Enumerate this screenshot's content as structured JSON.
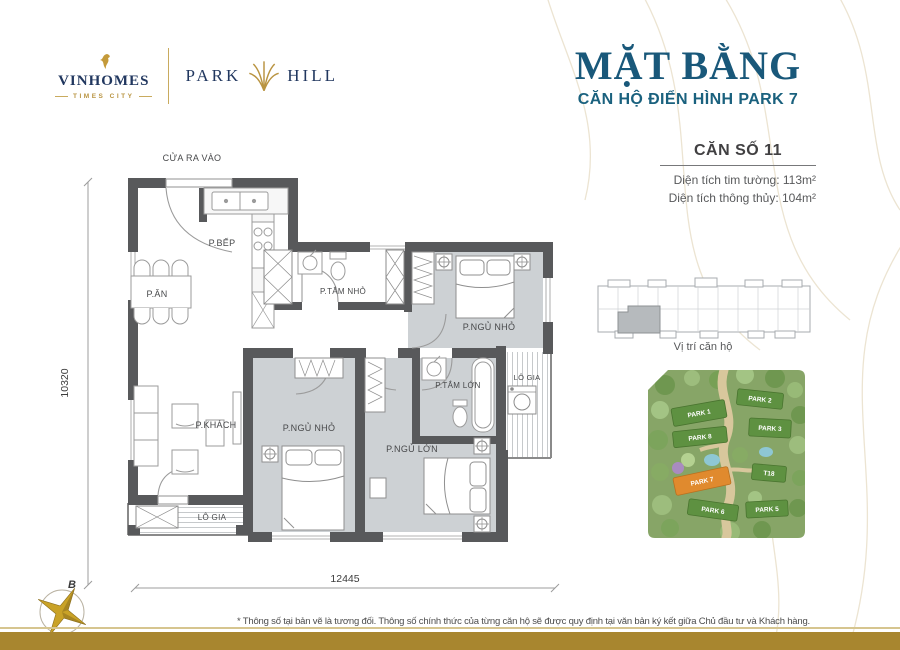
{
  "brand": {
    "vinhomes": "VINHOMES",
    "times_city": "TIMES CITY",
    "park": "PARK",
    "hill": "HILL"
  },
  "header": {
    "title": "MẶT BẰNG",
    "subtitle": "CĂN HỘ ĐIỂN HÌNH PARK 7"
  },
  "unit": {
    "label": "CĂN SỐ 11",
    "area_gross": "Diện tích tim tường: 113m²",
    "area_net": "Diện tích thông thủy: 104m²"
  },
  "plan": {
    "entrance": "CỬA RA VÀO",
    "kitchen": "P.BẾP",
    "dining": "P.ĂN",
    "bath_small": "P.TẮM NHỎ",
    "bedroom_top": "P.NGỦ NHỎ",
    "bath_large": "P.TẮM LỚN",
    "loggia_right": "LÔ GIA",
    "living": "P.KHÁCH",
    "bedroom_mid": "P.NGỦ NHỎ",
    "bedroom_master": "P.NGỦ LỚN",
    "loggia_left": "LÔ GIA",
    "dim_width": "12445",
    "dim_height": "10320"
  },
  "location": {
    "caption": "Vị trí căn hộ"
  },
  "sitemap": {
    "b1": "PARK 1",
    "b2": "PARK 2",
    "b3": "PARK 8",
    "b4": "PARK 3",
    "b5": "PARK 7",
    "b6": "T18",
    "b7": "PARK 6",
    "b8": "PARK 5"
  },
  "compass": {
    "north": "B"
  },
  "footer": {
    "note": "* Thông số tại bản vẽ là tương đối. Thông số chính thức của từng căn hộ sẽ được quy định tại văn bản ký kết giữa Chủ đầu tư và Khách hàng."
  },
  "colors": {
    "teal": "#19587a",
    "gold": "#a8862f",
    "navy": "#21375f",
    "wall": "#58595b",
    "floor_gray": "#cdd1d4",
    "highlight_orange": "#e08a2e"
  }
}
